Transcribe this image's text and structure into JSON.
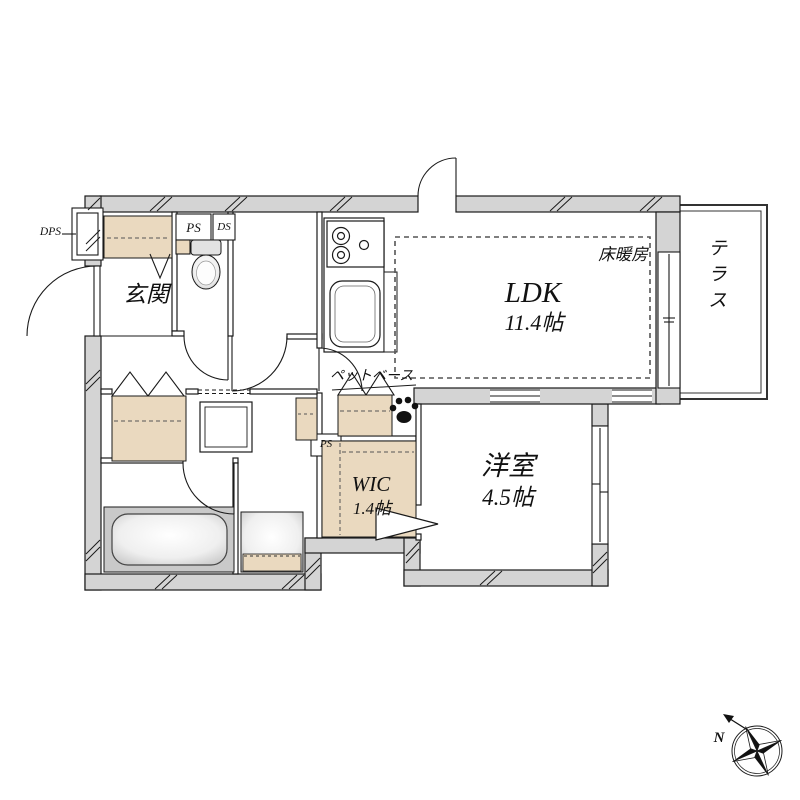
{
  "floor_plan": {
    "rooms": {
      "entrance": {
        "label": "玄関"
      },
      "ldk": {
        "label": "LDK",
        "size": "11.4帖"
      },
      "western_room": {
        "label": "洋室",
        "size": "4.5帖"
      },
      "wic": {
        "label": "WIC",
        "size": "1.4帖"
      },
      "terrace": {
        "label": "テラス"
      }
    },
    "features": {
      "floor_heating": "床暖房",
      "pet_base": "ペットベース"
    },
    "shafts": {
      "dps": "DPS",
      "ps_top": "PS",
      "ds_top": "DS",
      "ps_mid": "PS"
    },
    "compass": {
      "north": "N"
    },
    "colors": {
      "wall_fill": "#d4d4d4",
      "cabinet_fill": "#ead9bf",
      "fixture_gray": "#c9c9c9",
      "line": "#1a1a1a",
      "heating_dash": "#555555"
    }
  }
}
